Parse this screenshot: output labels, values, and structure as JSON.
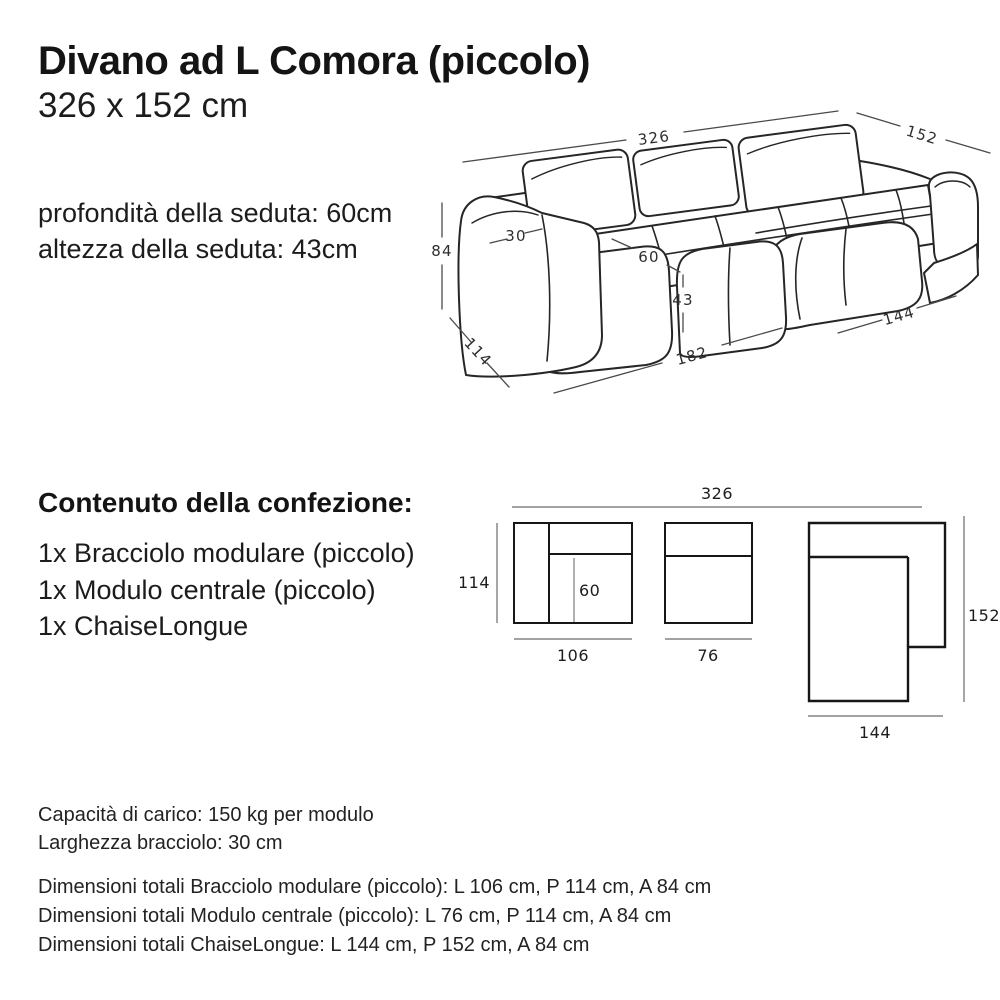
{
  "header": {
    "title": "Divano ad L Comora (piccolo)",
    "subtitle": "326 x 152 cm"
  },
  "seat_specs": {
    "line1": "profondità della seduta: 60cm",
    "line2": "altezza della seduta: 43cm"
  },
  "sofa_diagram": {
    "total_width": "326",
    "total_depth": "152",
    "height": "84",
    "arm_width": "30",
    "seat_depth": "60",
    "seat_height": "43",
    "side_depth": "114",
    "body_length": "182",
    "chaise_length": "144"
  },
  "package": {
    "heading": "Contenuto della confezione:",
    "items": [
      {
        "label": "1x Bracciolo modulare (piccolo)"
      },
      {
        "label": "1x Modulo centrale (piccolo)"
      },
      {
        "label": "1x ChaiseLongue"
      }
    ]
  },
  "layout_diagram": {
    "total_width": "326",
    "module_arm": {
      "width": "106",
      "depth": "114",
      "seat_depth": "60"
    },
    "module_center": {
      "width": "76"
    },
    "chaise": {
      "width": "144",
      "depth": "152"
    }
  },
  "load_specs": {
    "line1": "Capacità di carico: 150 kg per modulo",
    "line2": "Larghezza bracciolo: 30 cm"
  },
  "total_dimensions": {
    "line1": "Dimensioni totali Bracciolo modulare (piccolo): L 106 cm, P 114 cm, A 84 cm",
    "line2": "Dimensioni totali Modulo centrale (piccolo): L 76 cm, P 114 cm, A 84 cm",
    "line3": "Dimensioni totali ChaiseLongue: L 144 cm, P 152 cm, A 84 cm"
  },
  "colors": {
    "text": "#1a1a1a",
    "drawing_line": "#262626",
    "dimension_line": "#4a4a4a"
  }
}
